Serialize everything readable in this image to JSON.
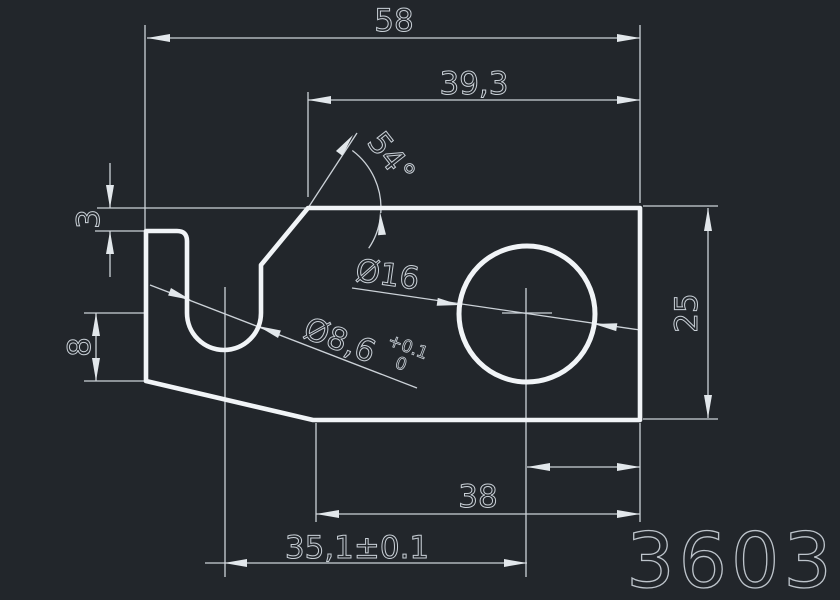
{
  "canvas": {
    "background": "#22262b",
    "outline_color": "#f1f4f7",
    "dimension_line_color": "#ccd2d8",
    "text_color": "#c9d0d7"
  },
  "labels": {
    "total_width": "58",
    "upper_width": "39,3",
    "bevel_angle": "54°",
    "lip_thickness": "3",
    "hook_depth": "8",
    "hole_diameter": "Ø16",
    "slot_diameter": "Ø8,6",
    "slot_tolerance_upper": "+0.1",
    "slot_tolerance_lower": "0",
    "part_height": "25",
    "hole_to_right_edge": "13,5",
    "bottom_width": "38",
    "slot_to_hole_spacing": "35,1±0.1",
    "drawing_number": "3603"
  }
}
